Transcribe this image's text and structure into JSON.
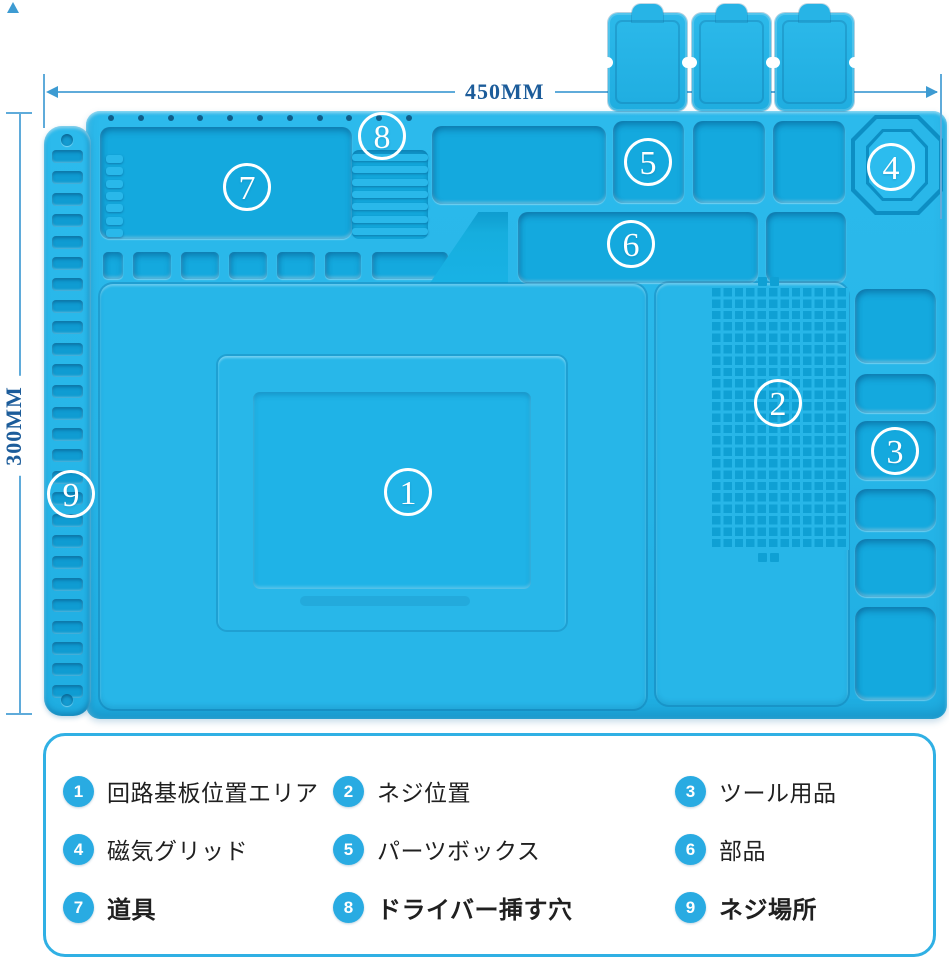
{
  "annotations": {
    "width_label": "450MM",
    "height_label": "300MM"
  },
  "mat": {
    "callouts": [
      {
        "num": "1"
      },
      {
        "num": "2"
      },
      {
        "num": "3"
      },
      {
        "num": "4"
      },
      {
        "num": "5"
      },
      {
        "num": "6"
      },
      {
        "num": "7"
      },
      {
        "num": "8"
      },
      {
        "num": "9"
      }
    ],
    "ladder_slot_count": 26,
    "top_hole_count": 11,
    "rib_count": 7,
    "tray7_tab_count": 7
  },
  "legend": {
    "items": [
      {
        "num": "1",
        "label": "回路基板位置エリア"
      },
      {
        "num": "2",
        "label": "ネジ位置"
      },
      {
        "num": "3",
        "label": "ツール用品"
      },
      {
        "num": "4",
        "label": "磁気グリッド"
      },
      {
        "num": "5",
        "label": "パーツボックス"
      },
      {
        "num": "6",
        "label": "部品"
      },
      {
        "num": "7",
        "label": "道具"
      },
      {
        "num": "8",
        "label": "ドライバー挿す穴"
      },
      {
        "num": "9",
        "label": "ネジ場所"
      }
    ]
  },
  "colors": {
    "mat": "#27b6e8",
    "recess": "#14a9de",
    "badge": "#29abe2",
    "dim_line": "#5fabda",
    "dim_text": "#1c5c9a",
    "legend_border": "#30b0e4"
  }
}
